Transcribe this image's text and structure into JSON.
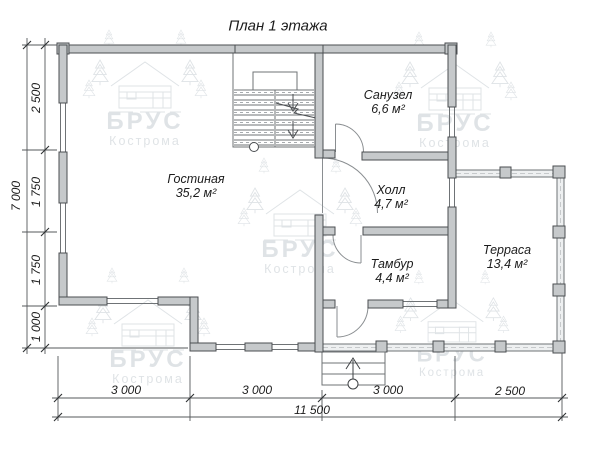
{
  "title": "План 1 этажа",
  "rooms": [
    {
      "name": "Гостиная",
      "area": "35,2 м²"
    },
    {
      "name": "Санузел",
      "area": "6,6 м²"
    },
    {
      "name": "Холл",
      "area": "4,7 м²"
    },
    {
      "name": "Тамбур",
      "area": "4,4 м²"
    },
    {
      "name": "Терраса",
      "area": "13,4 м²"
    }
  ],
  "dimensions": {
    "left": {
      "segments": [
        "2 500",
        "1 750",
        "1 750",
        "1 000"
      ],
      "total": "7 000"
    },
    "bottom": {
      "segments": [
        "3 000",
        "3 000",
        "3 000",
        "2 500"
      ],
      "total": "11 500"
    }
  },
  "watermark": {
    "brand": "БРУС",
    "city": "Кострома"
  },
  "colors": {
    "wall_fill": "#c6c9cb",
    "wall_outline": "#4b4e51",
    "thin_line": "#6f7376",
    "watermark": "#c0c8ce",
    "text": "#1c1c1c"
  }
}
